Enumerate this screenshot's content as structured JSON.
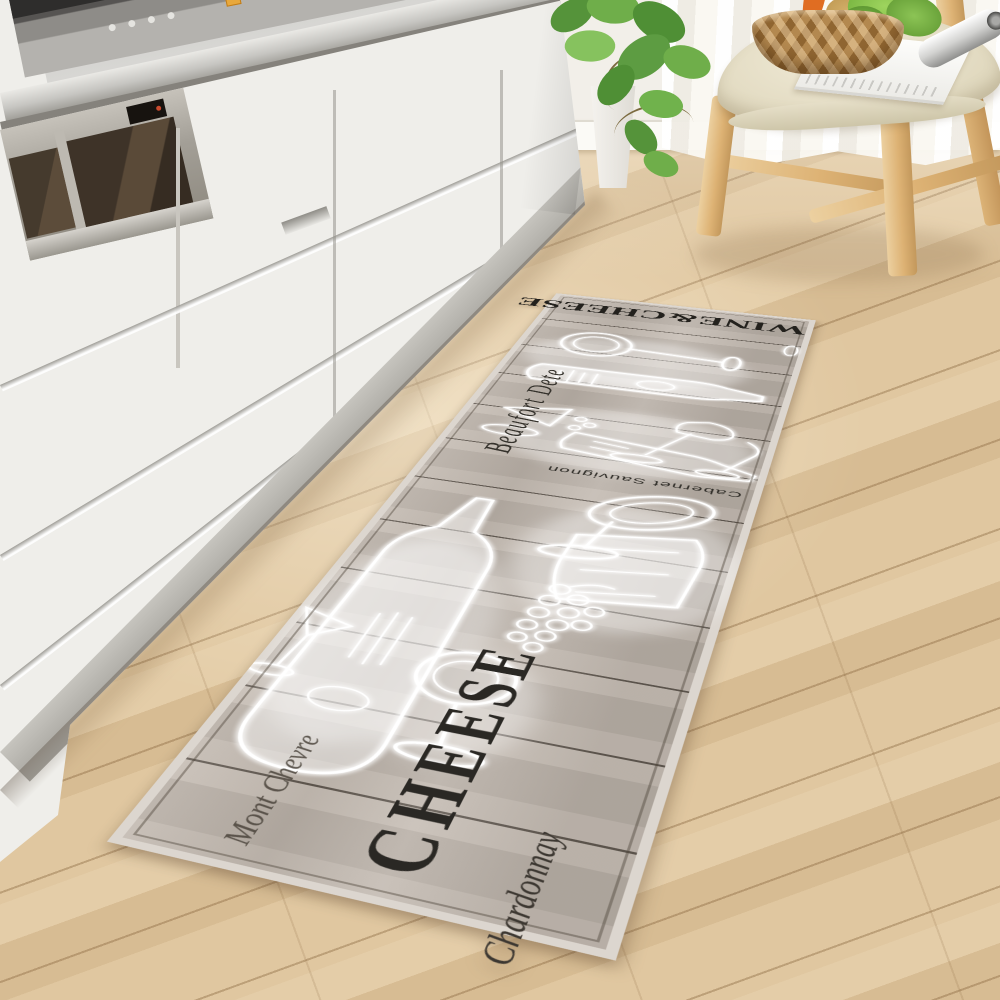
{
  "rug": {
    "title": "WINE&CHEESE",
    "script_top": "Beaufort Dete",
    "wine_label": "Cabernet Sauvignon",
    "big_word": "CHEESE",
    "script_mid": "Mont Chevre",
    "script_bottom": "Chardonnay"
  },
  "scene": {
    "description": "Kitchen with wine-and-cheese themed runner mat on wood floor",
    "palette": {
      "floor_wood": "#dcc09a",
      "floor_seam": "#b79a74",
      "rug_base": "#bcb3aa",
      "rug_seam": "#58504a",
      "rug_border": "#dcd6cf",
      "rug_text": "#23211d",
      "sketch_white": "#ffffff",
      "cabinet_white": "#efeeea",
      "counter_gray": "#c9c8c4",
      "appliance_glass": "#3e3328",
      "steel": "#a39f97",
      "wall": "#f2efe9",
      "curtain": "#faf8f3",
      "chair_wood": "#ddb274",
      "cushion": "#e9e2cc",
      "basket": "#a97c46",
      "lettuce_green": "#6fae3a",
      "carrot_orange": "#e06d22"
    }
  }
}
